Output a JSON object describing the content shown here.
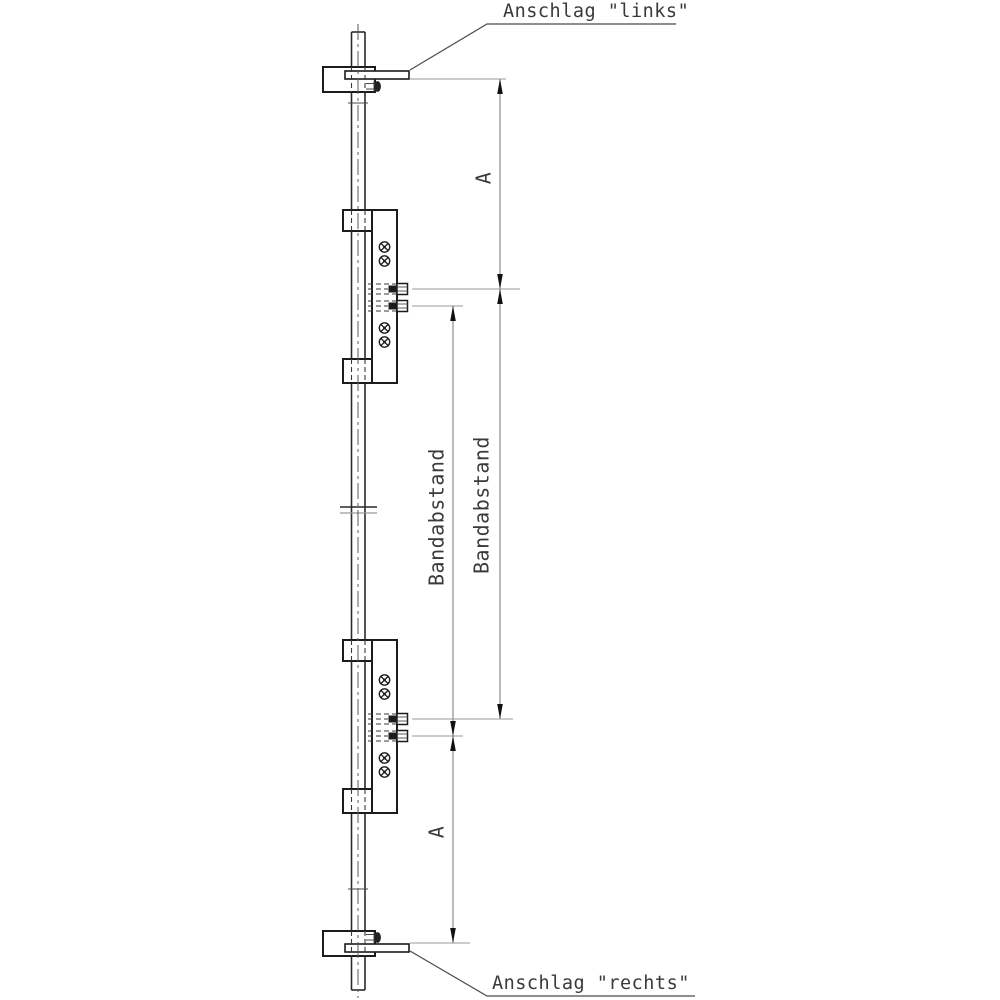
{
  "drawing": {
    "callouts": {
      "top": "Anschlag \"links\"",
      "bottom": "Anschlag \"rechts\""
    },
    "dimensions": {
      "a_top": "A",
      "a_bottom": "A",
      "bandabstand_left": "Bandabstand",
      "bandabstand_right": "Bandabstand"
    },
    "colors": {
      "background": "#ffffff",
      "main_line": "#1c1c1c",
      "thin_line": "#9a9a9a",
      "text": "#3a3a3a"
    }
  }
}
